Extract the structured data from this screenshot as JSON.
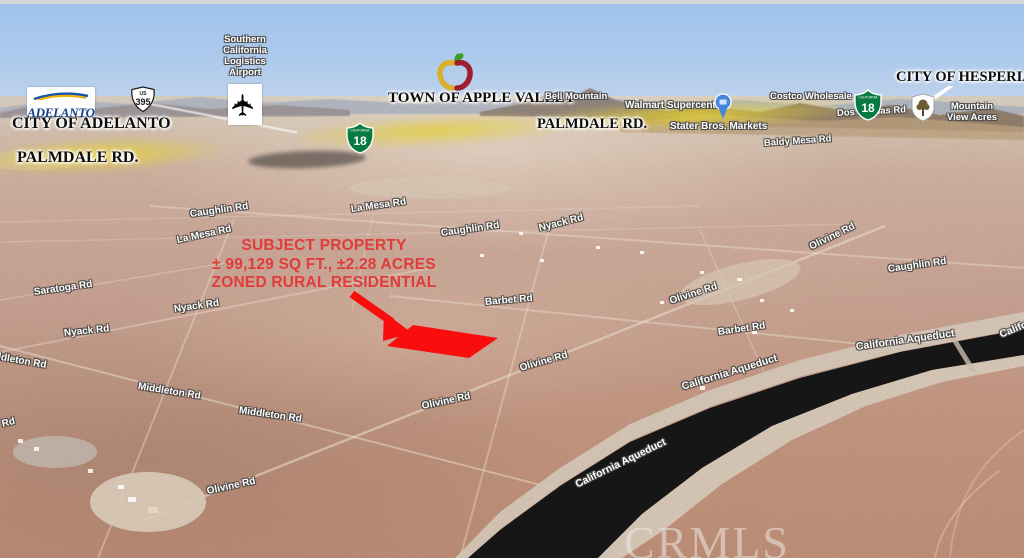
{
  "scene": {
    "watermark": "CRMLS",
    "city_labels": [
      "CITY OF ADELANTO",
      "PALMDALE RD.",
      "TOWN OF APPLE VALLEY",
      "PALMDALE RD.",
      "CITY OF HESPERIA"
    ],
    "poi": {
      "airport": "Southern\nCalifornia\nLogistics\nAirport",
      "bell_mountain": "Bell Mountain",
      "walmart": "Walmart Supercenter",
      "costco": "Costco Wholesale",
      "stater_bros": "Stater Bros. Markets",
      "mountain_view_acres": "Mountain\nView Acres"
    },
    "roads": [
      "Caughlin Rd",
      "La Mesa Rd",
      "Caughlin Rd",
      "Nyack Rd",
      "La Mesa Rd",
      "Olivine Rd",
      "Caughlin Rd",
      "Olivine Rd",
      "Barbet Rd",
      "Barbet Rd",
      "Saratoga Rd",
      "Nyack Rd",
      "Nyack Rd",
      "Middleton Rd",
      "Middleton Rd",
      "Middleton Rd",
      "Olivine Rd",
      "Olivine Rd",
      "Olivine Rd",
      "Rd",
      "Baldy Mesa Rd",
      "Dos Palmas Rd"
    ],
    "aqueduct": [
      "California Aqueduct",
      "California Aqueduct",
      "California Aqueduct",
      "California Aqueduct"
    ],
    "annotation": {
      "line1": "SUBJECT PROPERTY",
      "line2": "± 99,129 SQ FT., ±2.28 ACRES",
      "line3": "ZONED RURAL RESIDENTIAL"
    },
    "shields": {
      "us395_top": "US",
      "us395_num": "395",
      "ca_state": "CALIFORNIA",
      "ca18_num": "18"
    },
    "logos": {
      "adelanto": "ADELANTO"
    },
    "colors": {
      "annotation_red": "#e13b3b",
      "parcel_red": "#f90d0d",
      "highlight_yellow": "#e7d334",
      "aqueduct_black": "#161616",
      "shield_green": "#067a41"
    }
  }
}
